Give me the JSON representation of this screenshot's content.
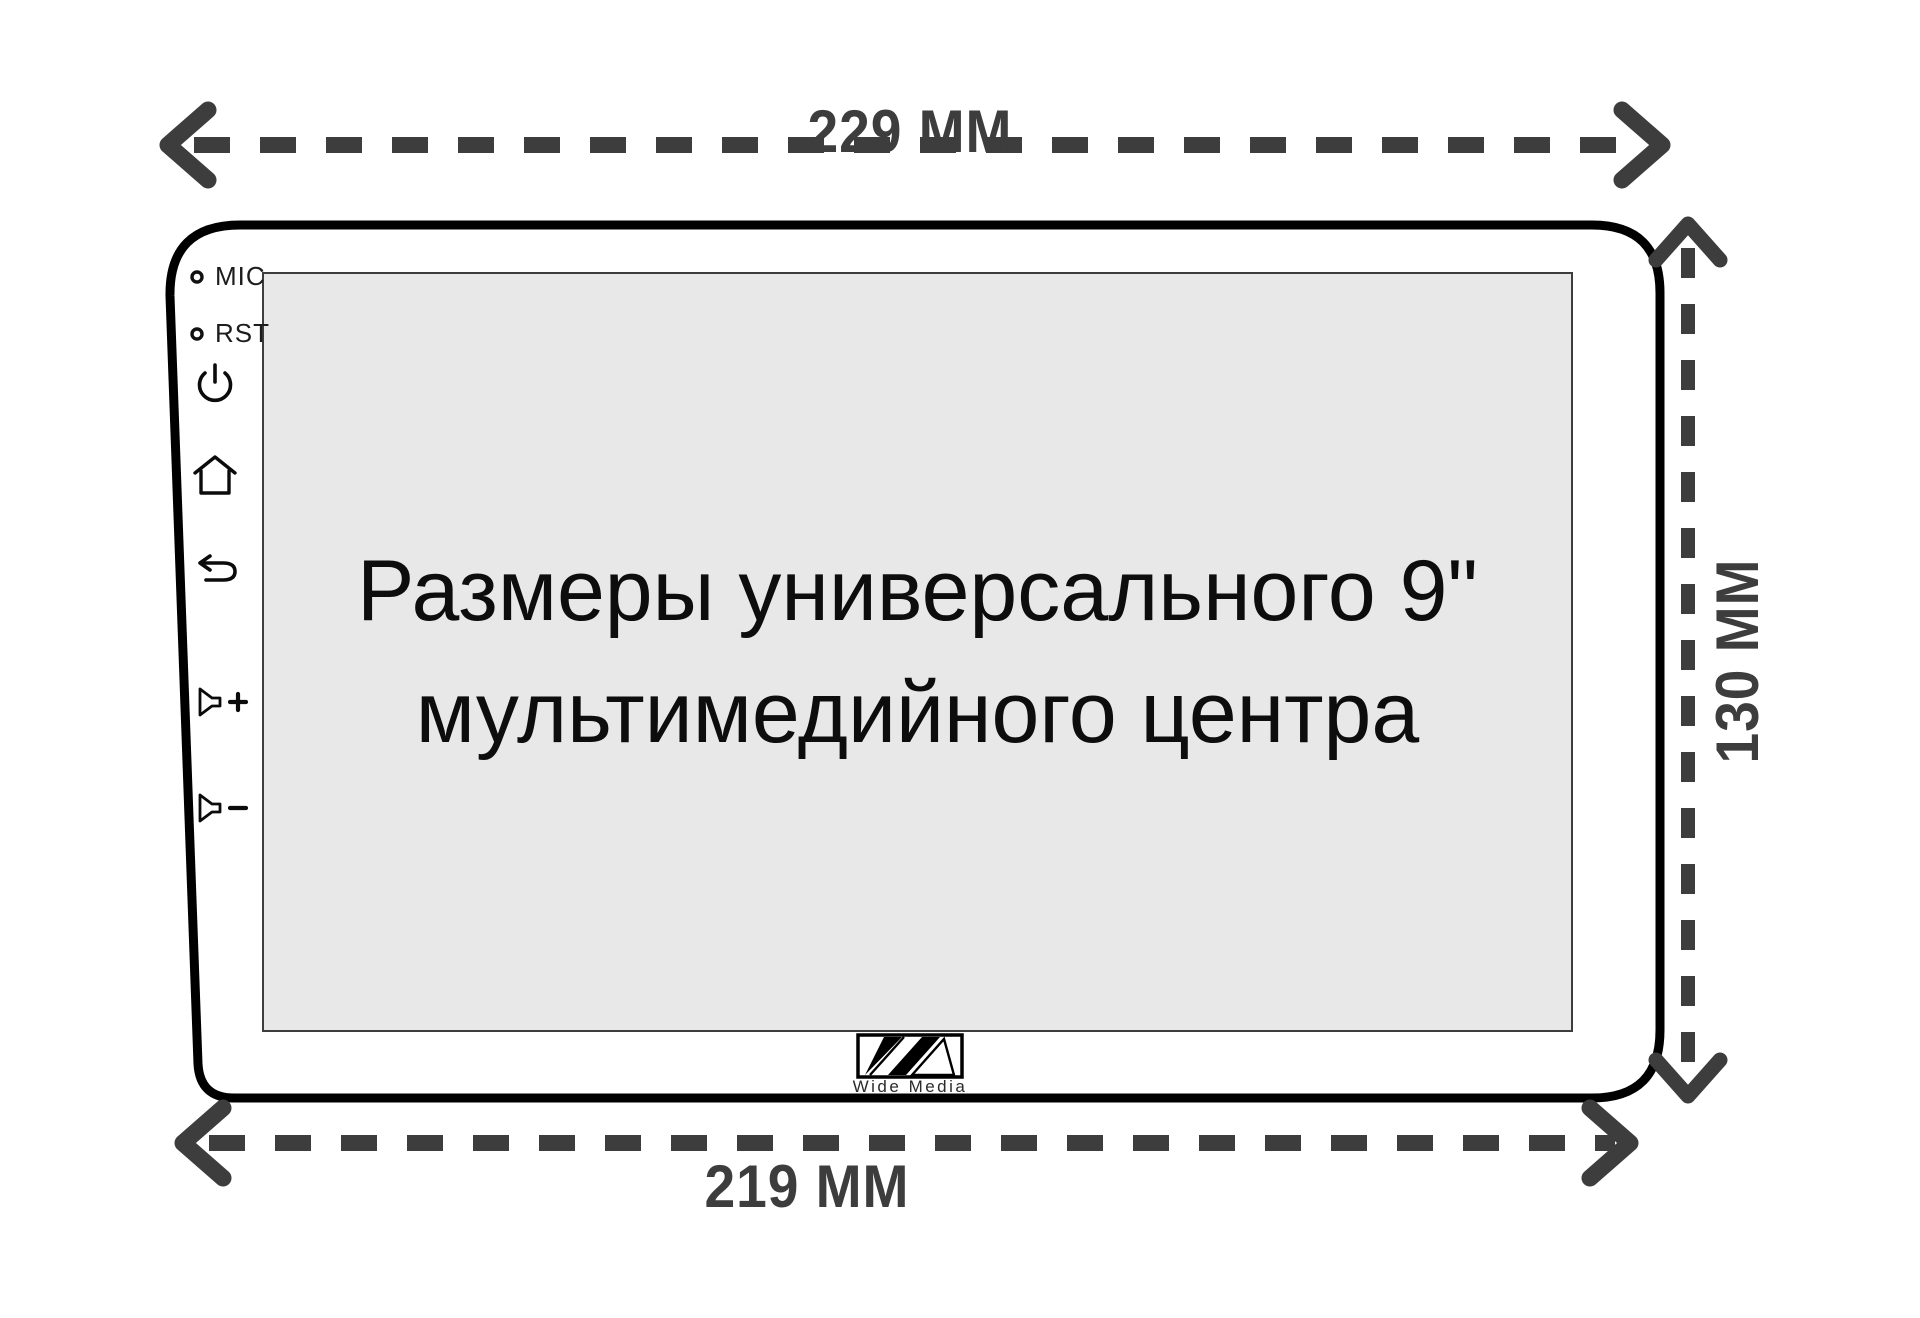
{
  "screen": {
    "line1": "Размеры универсального 9\"",
    "line2": "мультимедийного центра"
  },
  "dimensions": {
    "top": "229 MM",
    "bottom": "219 MM",
    "right": "130 MM"
  },
  "controls": {
    "mic_label": "MIC",
    "rst_label": "RST",
    "icons": {
      "mic_hole": "mic-hole-icon",
      "rst_hole": "reset-hole-icon",
      "power": "power-icon",
      "home": "home-icon",
      "back": "back-icon",
      "volume_up": "volume-up-icon",
      "volume_down": "volume-down-icon"
    }
  },
  "brand": {
    "name": "Wide Media",
    "logo": "wide-media-logo"
  },
  "colors": {
    "dimension_color": "#3d3d3d",
    "outline_color": "#000000",
    "screen_bg": "#e8e8e8",
    "background": "#ffffff"
  }
}
